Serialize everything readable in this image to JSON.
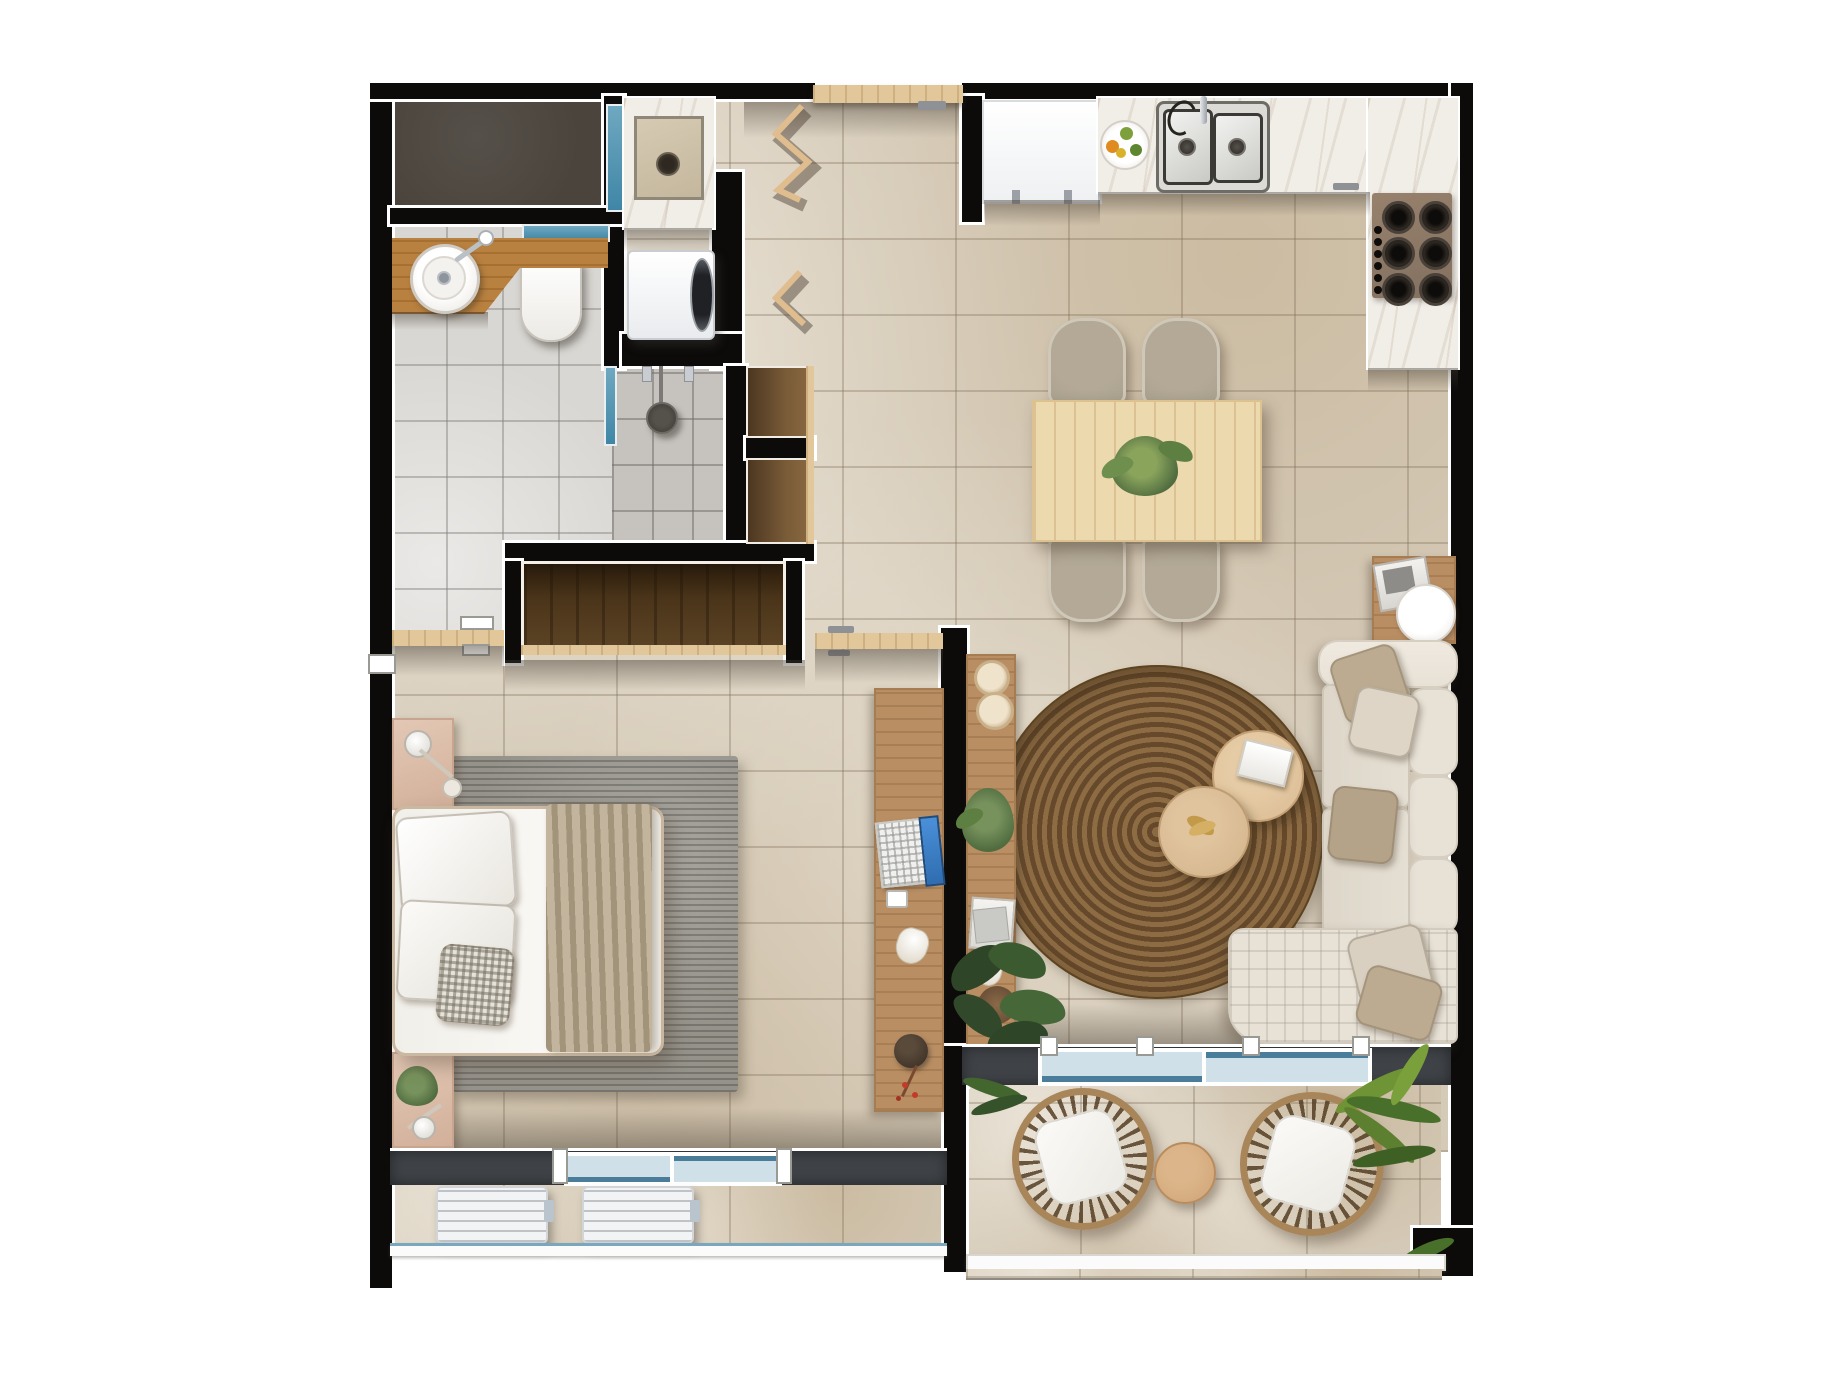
{
  "title": "apartment-floor-plan-top-view",
  "palette": {
    "wall": "#0c0b0a",
    "floor_tile": "#d5cab8",
    "bath_tile": "#d9d7d3",
    "shower_tile": "#c6c3be",
    "closet_floor": "#4a443c",
    "marble": "#f1eee8",
    "wood_light": "#e2c79a",
    "wood_mid": "#b98e63",
    "wood_counter": "#b9813f",
    "wardrobe_dark": "#5d4426",
    "charcoal": "#3f4347",
    "glass_teal": "#3f86a6",
    "glass_light": "#cfe0e8",
    "white": "#f6f4f1",
    "sofa": "#e7e1d6",
    "pillow_taupe": "#bcab90",
    "rug_jute_a": "#8d6c44",
    "rug_jute_b": "#66492a",
    "rug_gray": "#95928a",
    "chair_taupe": "#a99f8d",
    "rattan": "#a9855a",
    "green": "#4f6b3f",
    "green_dark": "#2f4527",
    "gold": "#c29a4a",
    "ac_white": "#f2f3f4",
    "screen_blue": "#2f6db0",
    "berry_red": "#c23b2a",
    "table_wood": "#ecd9ad",
    "coffee_wood": "#d9ba92"
  },
  "counts": {
    "dining_chairs": 4,
    "cooktop_burners": 6,
    "cooktop_knobs": 6,
    "ac_units": 2,
    "balcony_chairs": 2,
    "coffee_tables": 2,
    "wall_niches": 2,
    "sofa_back_cushions": 3,
    "window_panels_bedroom": 2,
    "sliding_glass_panels_balcony": 2
  },
  "inventory": [
    "closet-room",
    "bathroom",
    "shower",
    "laundry-area",
    "washing-machine",
    "laundry-sink",
    "entry-door",
    "accordion-door",
    "fridge",
    "kitchen-sink",
    "fruit-plate",
    "cooktop",
    "dining-table",
    "dining-chairs",
    "table-plant",
    "sofa",
    "side-table",
    "round-tray",
    "jute-rug",
    "coffee-tables",
    "console-shelf",
    "monstera-plant",
    "wardrobe",
    "bed",
    "nightstands",
    "bedroom-rug",
    "desk",
    "laptop",
    "bedroom-window",
    "ac-units",
    "balcony",
    "rattan-chairs",
    "balcony-table",
    "palm-plant"
  ]
}
